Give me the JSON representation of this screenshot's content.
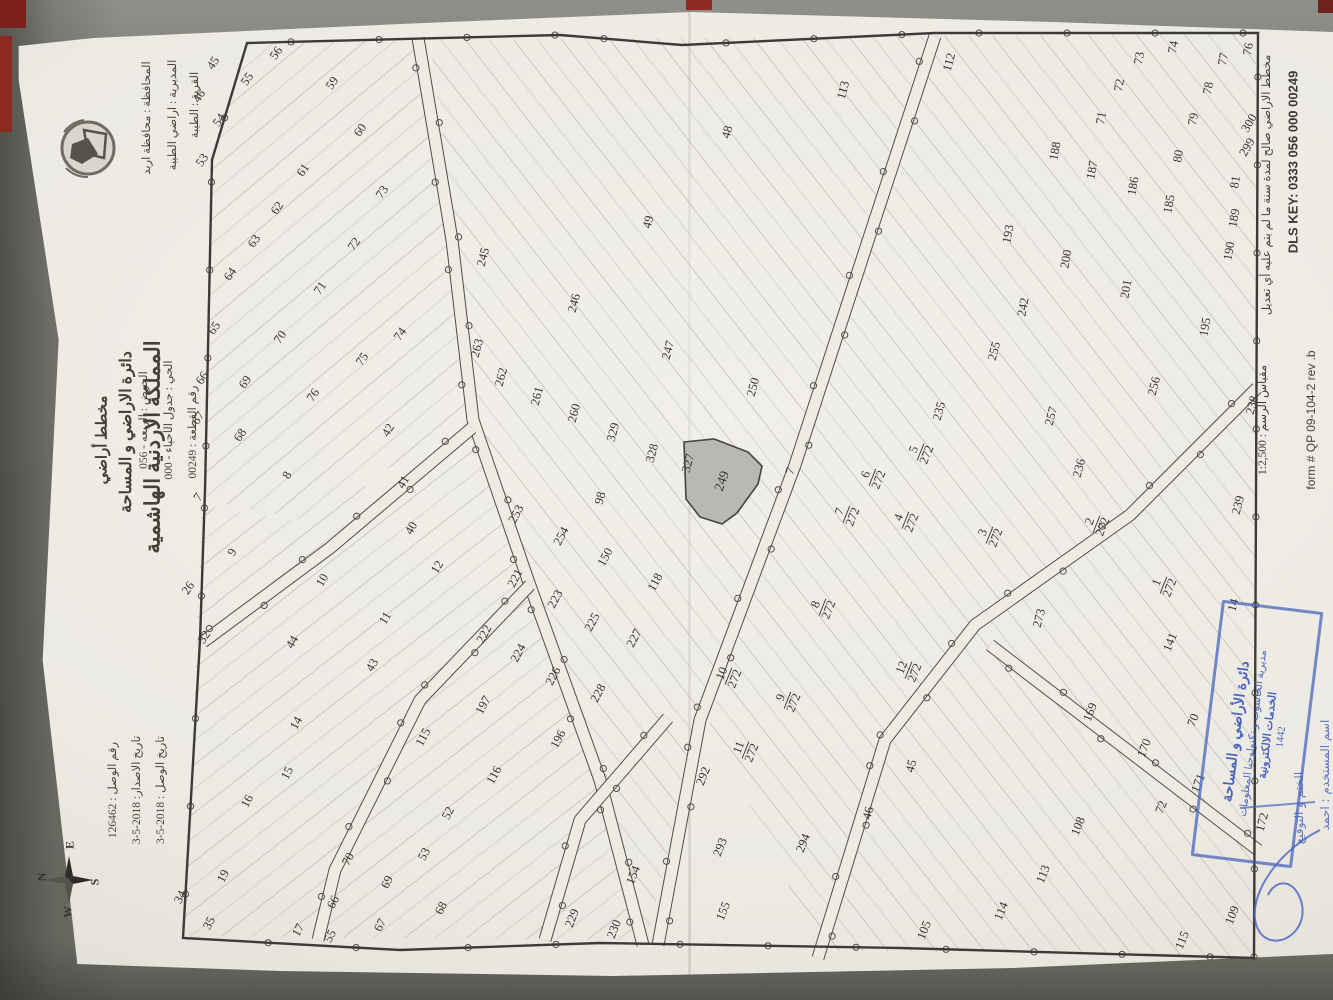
{
  "header": {
    "kingdom": "المملكة الاردنية الهاشمية",
    "department": "دائرة الاراضي و المساحة",
    "doc_type": "مخطط أراضي",
    "governorate": "المحافظة :  محافظة اربد",
    "directorate": "المديرية :  اراضي الطيبة",
    "village": "القرية :  الطيبة",
    "basin": "الحوض :  الربعه - 056",
    "quarter": "الحي :  جدول الأحياء - 000",
    "parcel_no": "رقم القطعة :  00249",
    "receipt_no": "رقم الوصل :  126462",
    "issue_date": "تاريخ الاصدار: 2018-5-3",
    "receipt_date": "تاريخ الوصل : 2018-5-3"
  },
  "margin": {
    "validity_note": "مخطط الاراضي صالح لمدة سنة ما لم يتم عليه أي تعديل",
    "dls_key": "DLS KEY: 0333  056  000  00249",
    "scale_label": "مقياس الرسم :  1:2,500",
    "form_no": "form # QP 09-104-2 rev .b"
  },
  "compass": {
    "n": "N",
    "e": "E",
    "s": "S",
    "w": "W"
  },
  "stamp": {
    "line1": "دائرة الأراضي و المساحة",
    "line2": "مديرية الحاسوب و تكنولوجيا المعلومات",
    "line3": "الخدمات الالكترونية",
    "year": "1442",
    "hand_sign_label": "الختم و التوقيع",
    "hand_user_label": "اسم المستخدم : احمد"
  },
  "map": {
    "highlight_label": "249",
    "border": [
      [
        247,
        43
      ],
      [
        560,
        35
      ],
      [
        682,
        45
      ],
      [
        935,
        33
      ],
      [
        1258,
        33
      ],
      [
        1254,
        958
      ],
      [
        900,
        948
      ],
      [
        600,
        943
      ],
      [
        400,
        950
      ],
      [
        183,
        938
      ],
      [
        200,
        640
      ],
      [
        205,
        490
      ],
      [
        212,
        160
      ]
    ],
    "highlight": [
      [
        684,
        442
      ],
      [
        714,
        439
      ],
      [
        748,
        452
      ],
      [
        762,
        466
      ],
      [
        758,
        484
      ],
      [
        737,
        513
      ],
      [
        722,
        524
      ],
      [
        700,
        517
      ],
      [
        686,
        499
      ]
    ],
    "regions": [
      {
        "angle": 50,
        "pts": [
          [
            248,
            44
          ],
          [
            418,
            40
          ],
          [
            470,
            420
          ],
          [
            300,
            520
          ],
          [
            204,
            500
          ],
          [
            212,
            160
          ]
        ]
      },
      {
        "angle": -38,
        "pts": [
          [
            430,
            40
          ],
          [
            928,
            36
          ],
          [
            795,
            465
          ],
          [
            700,
            715
          ],
          [
            648,
            935
          ],
          [
            607,
            780
          ],
          [
            533,
            580
          ],
          [
            480,
            425
          ]
        ]
      },
      {
        "angle": -38,
        "pts": [
          [
            940,
            36
          ],
          [
            1256,
            34
          ],
          [
            1254,
            956
          ],
          [
            820,
            950
          ],
          [
            706,
            715
          ],
          [
            800,
            470
          ]
        ]
      },
      {
        "angle": 52,
        "pts": [
          [
            202,
            505
          ],
          [
            298,
            522
          ],
          [
            468,
            432
          ],
          [
            526,
            580
          ],
          [
            606,
            782
          ],
          [
            640,
            940
          ],
          [
            185,
            936
          ]
        ]
      }
    ],
    "roads": [
      [
        [
          418,
          38
        ],
        [
          452,
          240
        ],
        [
          473,
          420
        ],
        [
          528,
          580
        ],
        [
          600,
          780
        ],
        [
          643,
          945
        ]
      ],
      [
        [
          935,
          36
        ],
        [
          865,
          250
        ],
        [
          795,
          465
        ],
        [
          700,
          720
        ],
        [
          658,
          945
        ]
      ],
      [
        [
          472,
          428
        ],
        [
          330,
          548
        ],
        [
          203,
          642
        ]
      ],
      [
        [
          1257,
          388
        ],
        [
          1130,
          515
        ],
        [
          975,
          625
        ],
        [
          885,
          740
        ],
        [
          818,
          958
        ]
      ],
      [
        [
          990,
          645
        ],
        [
          1258,
          850
        ]
      ],
      [
        [
          530,
          585
        ],
        [
          420,
          700
        ],
        [
          335,
          870
        ],
        [
          318,
          940
        ]
      ],
      [
        [
          668,
          718
        ],
        [
          580,
          820
        ],
        [
          545,
          940
        ]
      ]
    ],
    "parcels": [
      [
        "45",
        213,
        63,
        -55
      ],
      [
        "55",
        247,
        79,
        -55
      ],
      [
        "56",
        276,
        53,
        -55
      ],
      [
        "46",
        199,
        96,
        -55
      ],
      [
        "54",
        219,
        120,
        -55
      ],
      [
        "53",
        202,
        160,
        -55
      ],
      [
        "59",
        332,
        83,
        -55
      ],
      [
        "60",
        360,
        130,
        -55
      ],
      [
        "61",
        303,
        170,
        -55
      ],
      [
        "62",
        277,
        208,
        -55
      ],
      [
        "63",
        254,
        241,
        -55
      ],
      [
        "64",
        230,
        274,
        -55
      ],
      [
        "65",
        214,
        328,
        -55
      ],
      [
        "70",
        280,
        337,
        -55
      ],
      [
        "71",
        320,
        288,
        -55
      ],
      [
        "72",
        354,
        244,
        -55
      ],
      [
        "73",
        382,
        192,
        -55
      ],
      [
        "74",
        400,
        334,
        -55
      ],
      [
        "75",
        362,
        359,
        -55
      ],
      [
        "76",
        313,
        395,
        -55
      ],
      [
        "66",
        202,
        378,
        -55
      ],
      [
        "69",
        245,
        382,
        -55
      ],
      [
        "67",
        198,
        418,
        -55
      ],
      [
        "68",
        240,
        435,
        -55
      ],
      [
        "7",
        198,
        497,
        -55
      ],
      [
        "26",
        188,
        588,
        -55
      ],
      [
        "32",
        204,
        637,
        -55
      ],
      [
        "48",
        727,
        132,
        -75
      ],
      [
        "49",
        648,
        222,
        -75
      ],
      [
        "113",
        843,
        90,
        -75
      ],
      [
        "112",
        949,
        62,
        -75
      ],
      [
        "245",
        483,
        257,
        -75
      ],
      [
        "246",
        574,
        303,
        -75
      ],
      [
        "247",
        668,
        350,
        -75
      ],
      [
        "263",
        477,
        348,
        -75
      ],
      [
        "262",
        501,
        377,
        -75
      ],
      [
        "261",
        537,
        396,
        -75
      ],
      [
        "260",
        574,
        413,
        -75
      ],
      [
        "329",
        613,
        432,
        -75
      ],
      [
        "328",
        652,
        453,
        -75
      ],
      [
        "327",
        688,
        463,
        -75
      ],
      [
        "250",
        753,
        387,
        -75
      ],
      [
        "98",
        600,
        498,
        -75
      ],
      [
        "249",
        722,
        481,
        -70
      ],
      [
        "8",
        287,
        475,
        -60
      ],
      [
        "42",
        388,
        430,
        -60
      ],
      [
        "41",
        403,
        482,
        -60
      ],
      [
        "40",
        411,
        528,
        -60
      ],
      [
        "12",
        437,
        567,
        -60
      ],
      [
        "9",
        232,
        552,
        -60
      ],
      [
        "10",
        322,
        580,
        -60
      ],
      [
        "11",
        385,
        618,
        -60
      ],
      [
        "44",
        292,
        642,
        -60
      ],
      [
        "43",
        372,
        665,
        -60
      ],
      [
        "253",
        516,
        514,
        -62
      ],
      [
        "254",
        561,
        536,
        -62
      ],
      [
        "150",
        605,
        557,
        -62
      ],
      [
        "118",
        655,
        582,
        -62
      ],
      [
        "221",
        515,
        578,
        -62
      ],
      [
        "222",
        484,
        634,
        -62
      ],
      [
        "223",
        555,
        599,
        -62
      ],
      [
        "224",
        518,
        653,
        -62
      ],
      [
        "225",
        592,
        622,
        -62
      ],
      [
        "226",
        553,
        676,
        -62
      ],
      [
        "227",
        634,
        638,
        -62
      ],
      [
        "228",
        598,
        693,
        -62
      ],
      [
        "197",
        483,
        705,
        -62
      ],
      [
        "196",
        558,
        739,
        -62
      ],
      [
        "115",
        423,
        737,
        -62
      ],
      [
        "116",
        494,
        775,
        -62
      ],
      [
        "52",
        448,
        813,
        -62
      ],
      [
        "53",
        424,
        854,
        -62
      ],
      [
        "70",
        348,
        859,
        -62
      ],
      [
        "69",
        387,
        882,
        -62
      ],
      [
        "66",
        333,
        902,
        -62
      ],
      [
        "67",
        380,
        925,
        -62
      ],
      [
        "68",
        441,
        908,
        -62
      ],
      [
        "55",
        330,
        936,
        -62
      ],
      [
        "17",
        298,
        930,
        -62
      ],
      [
        "35",
        209,
        923,
        -62
      ],
      [
        "34",
        180,
        897,
        -62
      ],
      [
        "19",
        223,
        876,
        -62
      ],
      [
        "14",
        296,
        723,
        -62
      ],
      [
        "15",
        287,
        773,
        -62
      ],
      [
        "16",
        247,
        801,
        -62
      ],
      [
        "154",
        633,
        875,
        -68
      ],
      [
        "229",
        572,
        918,
        -68
      ],
      [
        "230",
        614,
        929,
        -68
      ],
      [
        "292",
        703,
        776,
        -68
      ],
      [
        "293",
        720,
        847,
        -68
      ],
      [
        "294",
        803,
        843,
        -68
      ],
      [
        "155",
        723,
        911,
        -68
      ],
      [
        "7",
        790,
        471,
        -70
      ],
      [
        "5",
        920,
        452,
        -68,
        "272"
      ],
      [
        "6",
        872,
        477,
        -68,
        "272"
      ],
      [
        "7",
        846,
        514,
        -68,
        "272"
      ],
      [
        "4",
        905,
        520,
        -68,
        "272"
      ],
      [
        "3",
        989,
        535,
        -68,
        "272"
      ],
      [
        "2",
        1096,
        524,
        -68,
        "272"
      ],
      [
        "8",
        822,
        607,
        -68,
        "272"
      ],
      [
        "1",
        1163,
        585,
        -68,
        "272"
      ],
      [
        "9",
        787,
        700,
        -68,
        "272"
      ],
      [
        "10",
        728,
        676,
        -68,
        "272"
      ],
      [
        "11",
        745,
        750,
        -68,
        "272"
      ],
      [
        "12",
        908,
        670,
        -68,
        "272"
      ],
      [
        "235",
        939,
        411,
        -75
      ],
      [
        "255",
        994,
        351,
        -75
      ],
      [
        "257",
        1051,
        416,
        -75
      ],
      [
        "236",
        1079,
        468,
        -75
      ],
      [
        "273",
        1039,
        618,
        -75
      ],
      [
        "256",
        1154,
        386,
        -75
      ],
      [
        "239",
        1238,
        505,
        -75
      ],
      [
        "238",
        1252,
        405,
        -75
      ],
      [
        "14",
        1233,
        605,
        -75
      ],
      [
        "46",
        868,
        813,
        -75
      ],
      [
        "45",
        911,
        766,
        -75
      ],
      [
        "172",
        1262,
        822,
        -75
      ],
      [
        "141",
        1170,
        642,
        -68
      ],
      [
        "169",
        1090,
        712,
        -68
      ],
      [
        "170",
        1144,
        748,
        -68
      ],
      [
        "70",
        1193,
        720,
        -68
      ],
      [
        "171",
        1198,
        783,
        -68
      ],
      [
        "72",
        1161,
        807,
        -68
      ],
      [
        "108",
        1078,
        826,
        -68
      ],
      [
        "113",
        1043,
        874,
        -68
      ],
      [
        "114",
        1001,
        911,
        -68
      ],
      [
        "105",
        924,
        930,
        -68
      ],
      [
        "109",
        1232,
        915,
        -68
      ],
      [
        "115",
        1182,
        940,
        -68
      ],
      [
        "73",
        1139,
        58,
        -80
      ],
      [
        "72",
        1119,
        85,
        -80
      ],
      [
        "71",
        1101,
        118,
        -80
      ],
      [
        "74",
        1173,
        47,
        -80
      ],
      [
        "77",
        1223,
        59,
        -80
      ],
      [
        "78",
        1208,
        88,
        -80
      ],
      [
        "79",
        1193,
        119,
        -80
      ],
      [
        "80",
        1178,
        156,
        -80
      ],
      [
        "81",
        1235,
        182,
        -80
      ],
      [
        "188",
        1055,
        151,
        -80
      ],
      [
        "187",
        1092,
        170,
        -80
      ],
      [
        "186",
        1133,
        186,
        -80
      ],
      [
        "185",
        1169,
        204,
        -80
      ],
      [
        "189",
        1234,
        218,
        -80
      ],
      [
        "190",
        1229,
        251,
        -80
      ],
      [
        "193",
        1008,
        234,
        -80
      ],
      [
        "200",
        1066,
        259,
        -80
      ],
      [
        "201",
        1126,
        289,
        -80
      ],
      [
        "242",
        1023,
        307,
        -80
      ],
      [
        "195",
        1205,
        327,
        -80
      ],
      [
        "299",
        1247,
        147,
        -60
      ],
      [
        "300",
        1249,
        123,
        -60
      ],
      [
        "76",
        1248,
        49,
        -80
      ]
    ],
    "colors": {
      "paper": "#edebe4",
      "line": "#504e47",
      "hatch": "#a09e95",
      "highlight_fill": "#b7b6b0",
      "stamp_blue": "#3f5ab8"
    }
  }
}
